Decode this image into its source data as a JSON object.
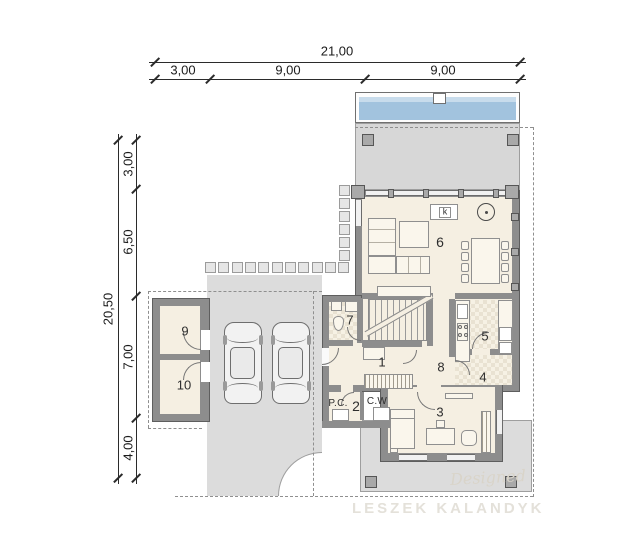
{
  "dimensions": {
    "top_total": "21,00",
    "top_segments": [
      "3,00",
      "9,00",
      "9,00"
    ],
    "left_total": "20,50",
    "left_segments": [
      "3,00",
      "6,50",
      "7,00",
      "4,00"
    ]
  },
  "rooms": {
    "r1": "1",
    "r2": "2",
    "r3": "3",
    "r4": "4",
    "r5": "5",
    "r6": "6",
    "r7": "7",
    "r8": "8",
    "r9": "9",
    "r10": "10"
  },
  "annotations": {
    "pc": "P.C.",
    "cw": "C.W",
    "fireplace_k": "k"
  },
  "watermarks": {
    "script": "Designed",
    "studio": "LESZEK KALANDYK"
  },
  "colors": {
    "wall": "#8d8d8d",
    "interior": "#f5efe2",
    "paving": "#dcdcdc",
    "pool_water": "#a2c3de",
    "dimension_text": "#1b1b1b"
  }
}
